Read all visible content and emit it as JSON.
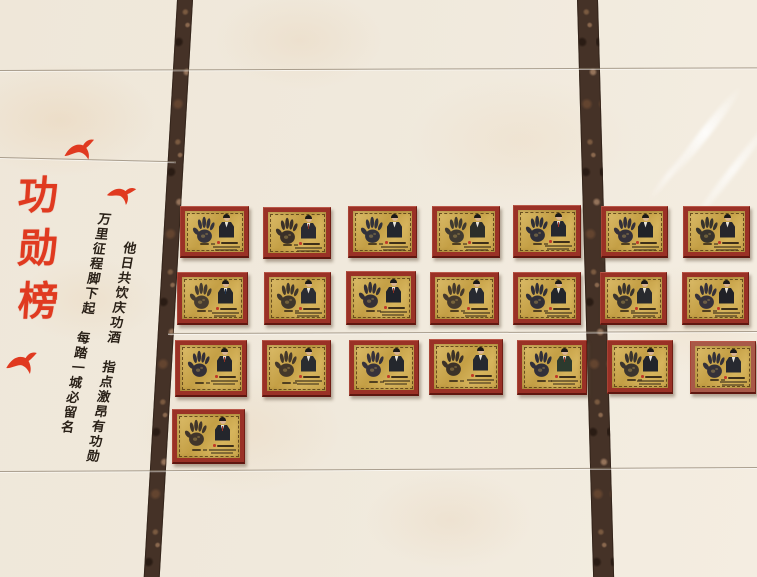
{
  "scene": {
    "kind": "honor-roll wall photograph",
    "title": {
      "text": "功勋榜",
      "chars": [
        "功",
        "勋",
        "榜"
      ],
      "color": "#e03a20"
    },
    "verses": {
      "right": "他日共饮庆功酒　指点激昂有功勋",
      "left": "万里征程脚下起　每踏一城必留名",
      "color": "#2a2118"
    },
    "colors": {
      "red": "#e03a20",
      "tile": "#eee6d8",
      "tile_shade": "#e6d4bc",
      "strip_dark": "#453227",
      "strip_light": "#8a664b",
      "frame": "#9a3126",
      "plate_gold": "#cfae58",
      "plate_border": "#5a431c",
      "hand_ink": "#32313a"
    },
    "seams": [
      {
        "y": 70,
        "x": 0,
        "w": 757,
        "rot": -0.2
      },
      {
        "y": 157,
        "x": 0,
        "w": 176,
        "rot": 1.4
      },
      {
        "y": 333,
        "x": 168,
        "w": 589,
        "rot": -0.2
      },
      {
        "y": 471,
        "x": 0,
        "w": 757,
        "rot": -0.3
      }
    ],
    "strips": {
      "left": {
        "x": 177,
        "width": 16,
        "skew": -3.3
      },
      "right": {
        "x": 577,
        "width": 21,
        "skew": 1.6
      }
    },
    "birds": [
      {
        "x": 63,
        "y": 140,
        "w": 34,
        "h": 24,
        "rot": -10
      },
      {
        "x": 106,
        "y": 185,
        "w": 30,
        "h": 22,
        "rot": 8
      },
      {
        "x": 5,
        "y": 352,
        "w": 34,
        "h": 26,
        "rot": -6
      }
    ],
    "plaques": [
      {
        "r": 1,
        "c": 1,
        "x": 180,
        "y": 206,
        "w": 69,
        "h": 52,
        "hand": "#35333c",
        "suit": "#24242c",
        "tie": "none"
      },
      {
        "r": 1,
        "c": 2,
        "x": 263,
        "y": 207,
        "w": 68,
        "h": 52,
        "hand": "#3a3028",
        "suit": "#2a2a32",
        "tie": "#8a2f24"
      },
      {
        "r": 1,
        "c": 3,
        "x": 348,
        "y": 206,
        "w": 69,
        "h": 52,
        "hand": "#32323b",
        "suit": "#23262e",
        "tie": "none"
      },
      {
        "r": 1,
        "c": 4,
        "x": 432,
        "y": 206,
        "w": 68,
        "h": 52,
        "hand": "#403a30",
        "suit": "#2c2e2a",
        "tie": "none"
      },
      {
        "r": 1,
        "c": 5,
        "x": 513,
        "y": 205,
        "w": 68,
        "h": 53,
        "hand": "#2f2f38",
        "suit": "#24282f",
        "tie": "#a03226"
      },
      {
        "r": 1,
        "c": 6,
        "x": 601,
        "y": 206,
        "w": 67,
        "h": 52,
        "hand": "#343039",
        "suit": "#202228",
        "tie": "none"
      },
      {
        "r": 1,
        "c": 7,
        "x": 683,
        "y": 206,
        "w": 67,
        "h": 52,
        "hand": "#37332c",
        "suit": "#26262c",
        "tie": "none"
      },
      {
        "r": 2,
        "c": 1,
        "x": 177,
        "y": 272,
        "w": 71,
        "h": 53,
        "hand": "#463c30",
        "suit": "#24262b",
        "tie": "#1f3350"
      },
      {
        "r": 2,
        "c": 2,
        "x": 264,
        "y": 272,
        "w": 67,
        "h": 53,
        "hand": "#3f362b",
        "suit": "#2a2d33",
        "tie": "none"
      },
      {
        "r": 2,
        "c": 3,
        "x": 346,
        "y": 271,
        "w": 70,
        "h": 54,
        "hand": "#332f36",
        "suit": "#1f222a",
        "tie": "#922f23"
      },
      {
        "r": 2,
        "c": 4,
        "x": 430,
        "y": 272,
        "w": 69,
        "h": 53,
        "hand": "#45392c",
        "suit": "#272a31",
        "tie": "none"
      },
      {
        "r": 2,
        "c": 5,
        "x": 513,
        "y": 272,
        "w": 68,
        "h": 53,
        "hand": "#302f37",
        "suit": "#23252b",
        "tie": "none"
      },
      {
        "r": 2,
        "c": 6,
        "x": 600,
        "y": 272,
        "w": 67,
        "h": 53,
        "hand": "#3a342d",
        "suit": "#282a2e",
        "tie": "none"
      },
      {
        "r": 2,
        "c": 7,
        "x": 682,
        "y": 272,
        "w": 67,
        "h": 53,
        "hand": "#35313a",
        "suit": "#202127",
        "tie": "none"
      },
      {
        "r": 3,
        "c": 1,
        "x": 175,
        "y": 340,
        "w": 72,
        "h": 57,
        "hand": "#332f37",
        "suit": "#23252c",
        "tie": "#963024"
      },
      {
        "r": 3,
        "c": 2,
        "x": 262,
        "y": 340,
        "w": 69,
        "h": 57,
        "hand": "#44382a",
        "suit": "#2a2c30",
        "tie": "none"
      },
      {
        "r": 3,
        "c": 3,
        "x": 349,
        "y": 340,
        "w": 70,
        "h": 56,
        "hand": "#36323b",
        "suit": "#24272d",
        "tie": "none"
      },
      {
        "r": 3,
        "c": 4,
        "x": 429,
        "y": 339,
        "w": 74,
        "h": 56,
        "hand": "#3c3228",
        "suit": "#26292f",
        "tie": "none"
      },
      {
        "r": 3,
        "c": 5,
        "x": 517,
        "y": 340,
        "w": 70,
        "h": 55,
        "hand": "#31303a",
        "suit": "#2c3a2e",
        "tie": "#8d2d22"
      },
      {
        "r": 3,
        "c": 6,
        "x": 607,
        "y": 340,
        "w": 66,
        "h": 54,
        "hand": "#3b352e",
        "suit": "#22242a",
        "tie": "none"
      },
      {
        "r": 3,
        "c": 7,
        "x": 690,
        "y": 341,
        "w": 66,
        "h": 53,
        "hand": "#343139",
        "suit": "#272930",
        "tie": "none",
        "frame": "#a85948"
      },
      {
        "r": 4,
        "c": 1,
        "x": 172,
        "y": 409,
        "w": 73,
        "h": 55,
        "hand": "#41352a",
        "suit": "#24262c",
        "tie": "#9e3126"
      }
    ]
  }
}
